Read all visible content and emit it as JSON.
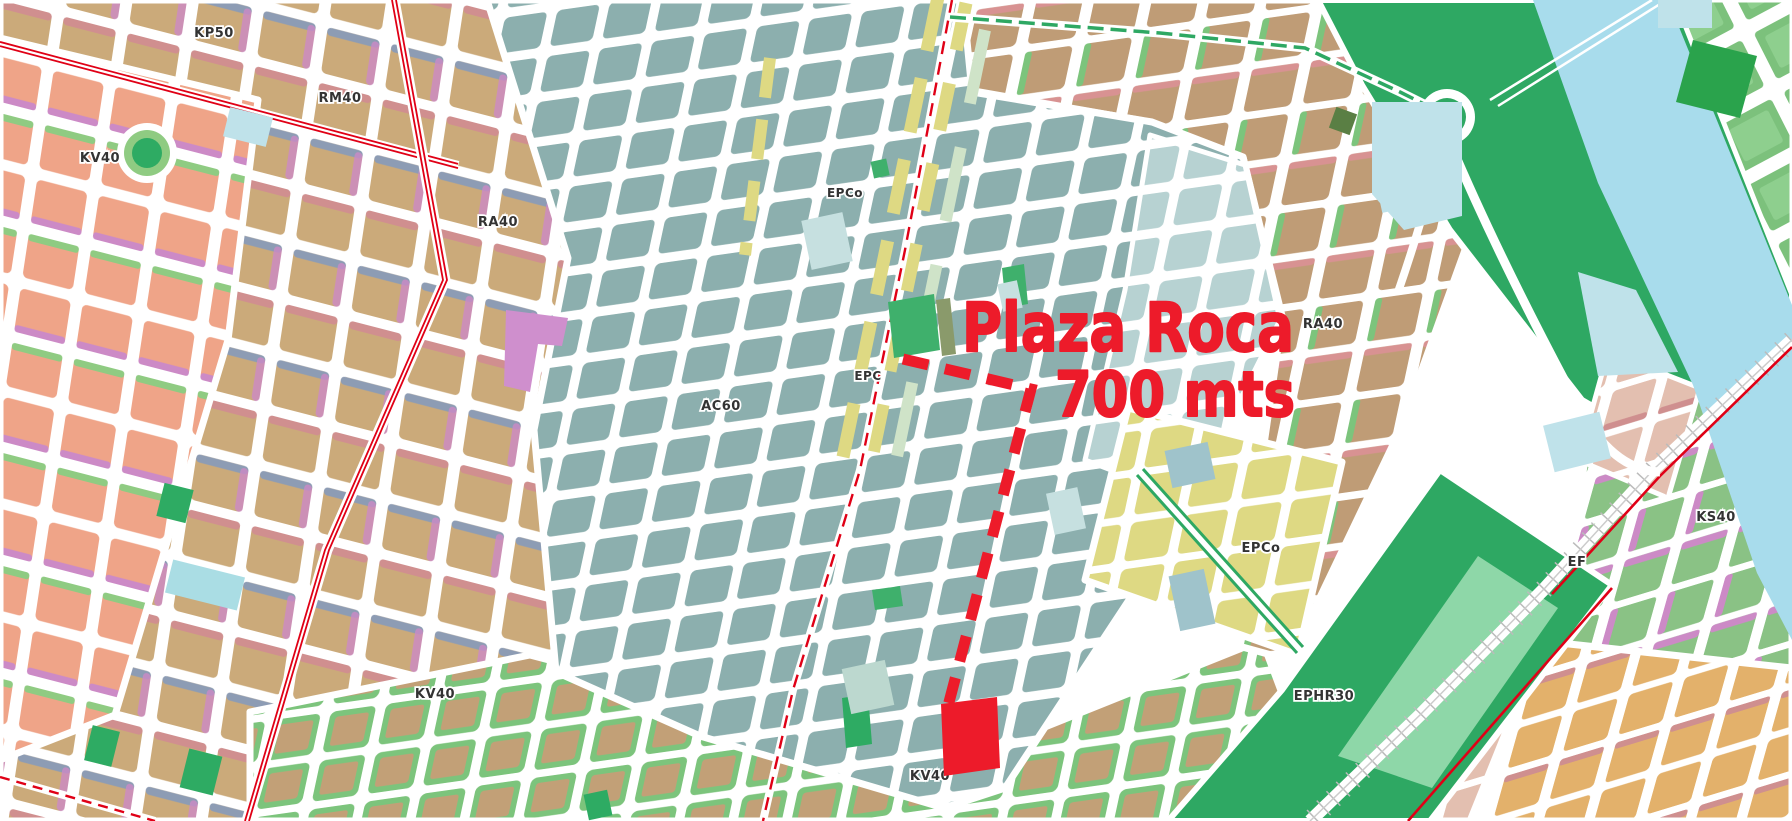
{
  "annotation": {
    "title": "Plaza Roca",
    "distance": "700 mts",
    "line_color": "#ed1b2a"
  },
  "map_labels": [
    {
      "text": "KP50"
    },
    {
      "text": "RM40"
    },
    {
      "text": "KV40"
    },
    {
      "text": "RA40"
    },
    {
      "text": "EPCo"
    },
    {
      "text": "EPC"
    },
    {
      "text": "AC60"
    },
    {
      "text": "RA40"
    },
    {
      "text": "EPCo"
    },
    {
      "text": "KS40"
    },
    {
      "text": "EF"
    },
    {
      "text": "EPHR30"
    },
    {
      "text": "KV40"
    },
    {
      "text": "KV40"
    }
  ],
  "colors": {
    "street": "#ffffff",
    "block_teal": "#8cafae",
    "block_teal_light": "#b7d2d2",
    "block_tan": "#cbaa7a",
    "block_brown": "#bf9c76",
    "block_salmon": "#efa488",
    "block_yellow": "#ded983",
    "block_green_suburb": "#7cc17c",
    "block_pink": "#e3bfb0",
    "block_orange": "#e3b16b",
    "strip_rose": "#d08f8f",
    "strip_slate": "#8d9cb4",
    "strip_orchid": "#cc8ac6",
    "strip_green": "#7cc47c",
    "park_green": "#2ea863",
    "plaza_green": "#3fb06c",
    "river_blue": "#a8dcec",
    "parcel_lightblue": "#bfe2ea",
    "violet_parcel": "#cf8fcd",
    "avenue_red": "#e00016",
    "annotation_red": "#ed1b2a",
    "label_dark": "#333333"
  }
}
